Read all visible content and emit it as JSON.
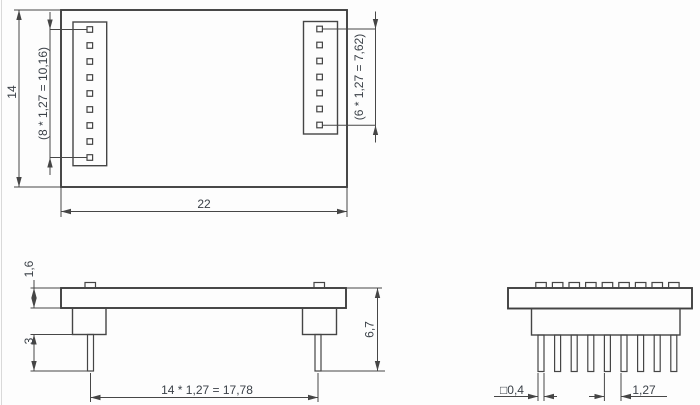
{
  "top_view": {
    "height_label": "14",
    "width_label": "22",
    "left_pin_row_label": "(8 * 1,27 = 10,16)",
    "right_pin_row_label": "(6 * 1,27 = 7,62)",
    "left_pin_count": 9,
    "right_pin_count": 7
  },
  "front_view": {
    "board_thickness_label": "1,6",
    "pin_protrusion_label": "3",
    "overall_height_label": "6,7",
    "pin_row_span_label": "14 * 1,27 = 17,78"
  },
  "side_view": {
    "pin_width_label": "□0,4",
    "pin_pitch_label": "1,27",
    "pin_count": 9
  },
  "colors": {
    "line": "#454545",
    "text": "#3a4047",
    "background": "#fdfdfd"
  }
}
